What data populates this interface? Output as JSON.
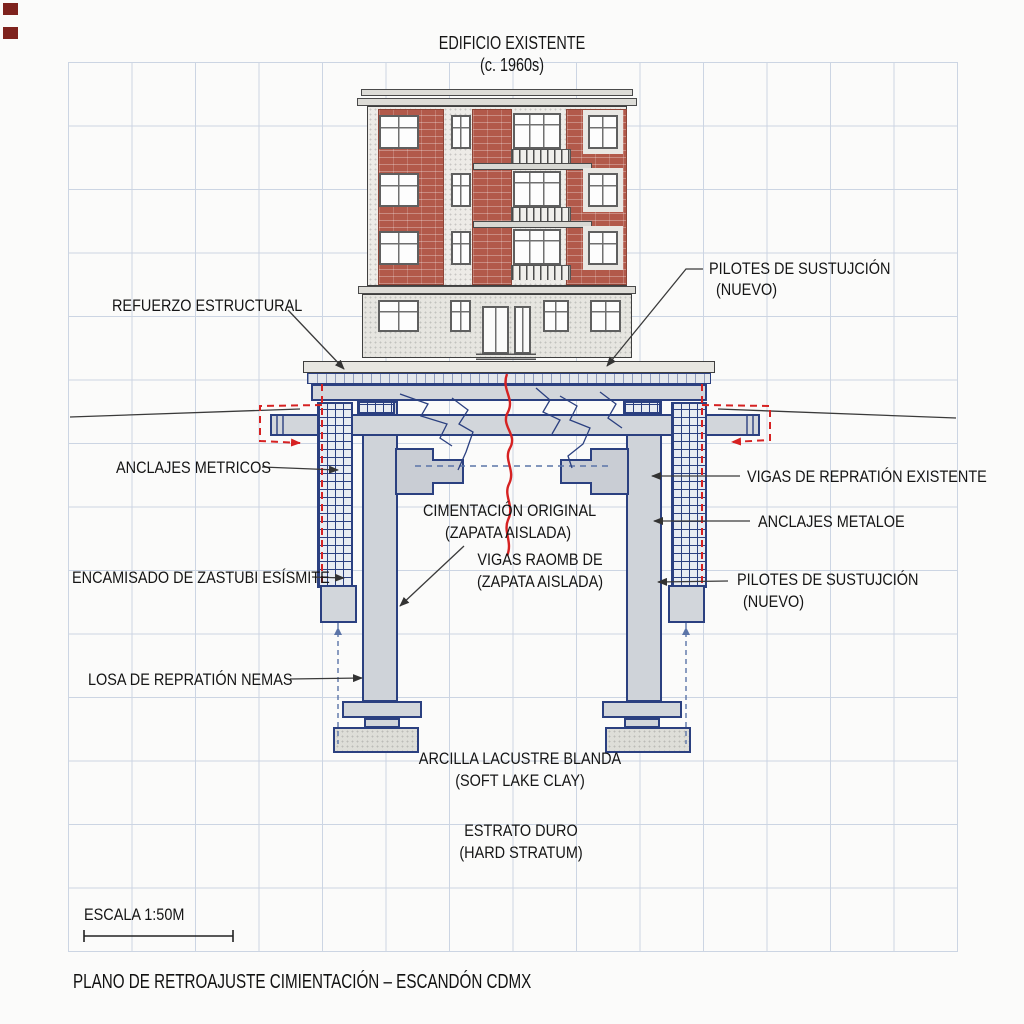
{
  "drawing": {
    "title_line1": "EDIFICIO EXISTENTE",
    "title_line2": "(c. 1960s)",
    "footer_title": "PLANO DE RETROAJUSTE CIMIENTACIÓN – ESCANDÓN CDMX",
    "scale": {
      "label": "ESCALA 1:50M"
    },
    "annotations": {
      "refuerzo_estructural": "REFUERZO ESTRUCTURAL",
      "pilotes_nuevo_top": {
        "line1": "PILOTES DE SUSTUJCIÓN",
        "line2": "(NUEVO)"
      },
      "anclajes_metricos": "ANCLAJES METRICOS",
      "vigas_reparticion_existente": "VIGAS DE REPRATIÓN EXISTENTE",
      "cimentacion_original": {
        "line1": "CIMENTACIÓN ORIGINAL",
        "line2": "(ZAPATA AISLADA)"
      },
      "anclajes_metaloe": "ANCLAJES METALOE",
      "encamisado": "ENCAMISADO DE ZASTUBI ESÍSMITE",
      "vigas_raomb": {
        "line1": "VIGAS RAOMB DE",
        "line2": "(ZAPATA AISLADA)"
      },
      "pilotes_nuevo_mid": {
        "line1": "PILOTES DE SUSTUJCIÓN",
        "line2": "(NUEVO)"
      },
      "losa_reparticion": "LOSA DE REPRATIÓN NEMAS",
      "arcilla": {
        "line1": "ARCILLA LACUSTRE BLANDA",
        "line2": "(SOFT LAKE CLAY)"
      },
      "estrato": {
        "line1": "ESTRATO DURO",
        "line2": "(HARD STRATUM)"
      }
    },
    "colors": {
      "line_blue": "#2b4080",
      "annotation_red": "#d62222",
      "brick": "#b2594a",
      "grid_line": "#ccd5e3",
      "concrete_fill": "#d2d6db"
    }
  }
}
